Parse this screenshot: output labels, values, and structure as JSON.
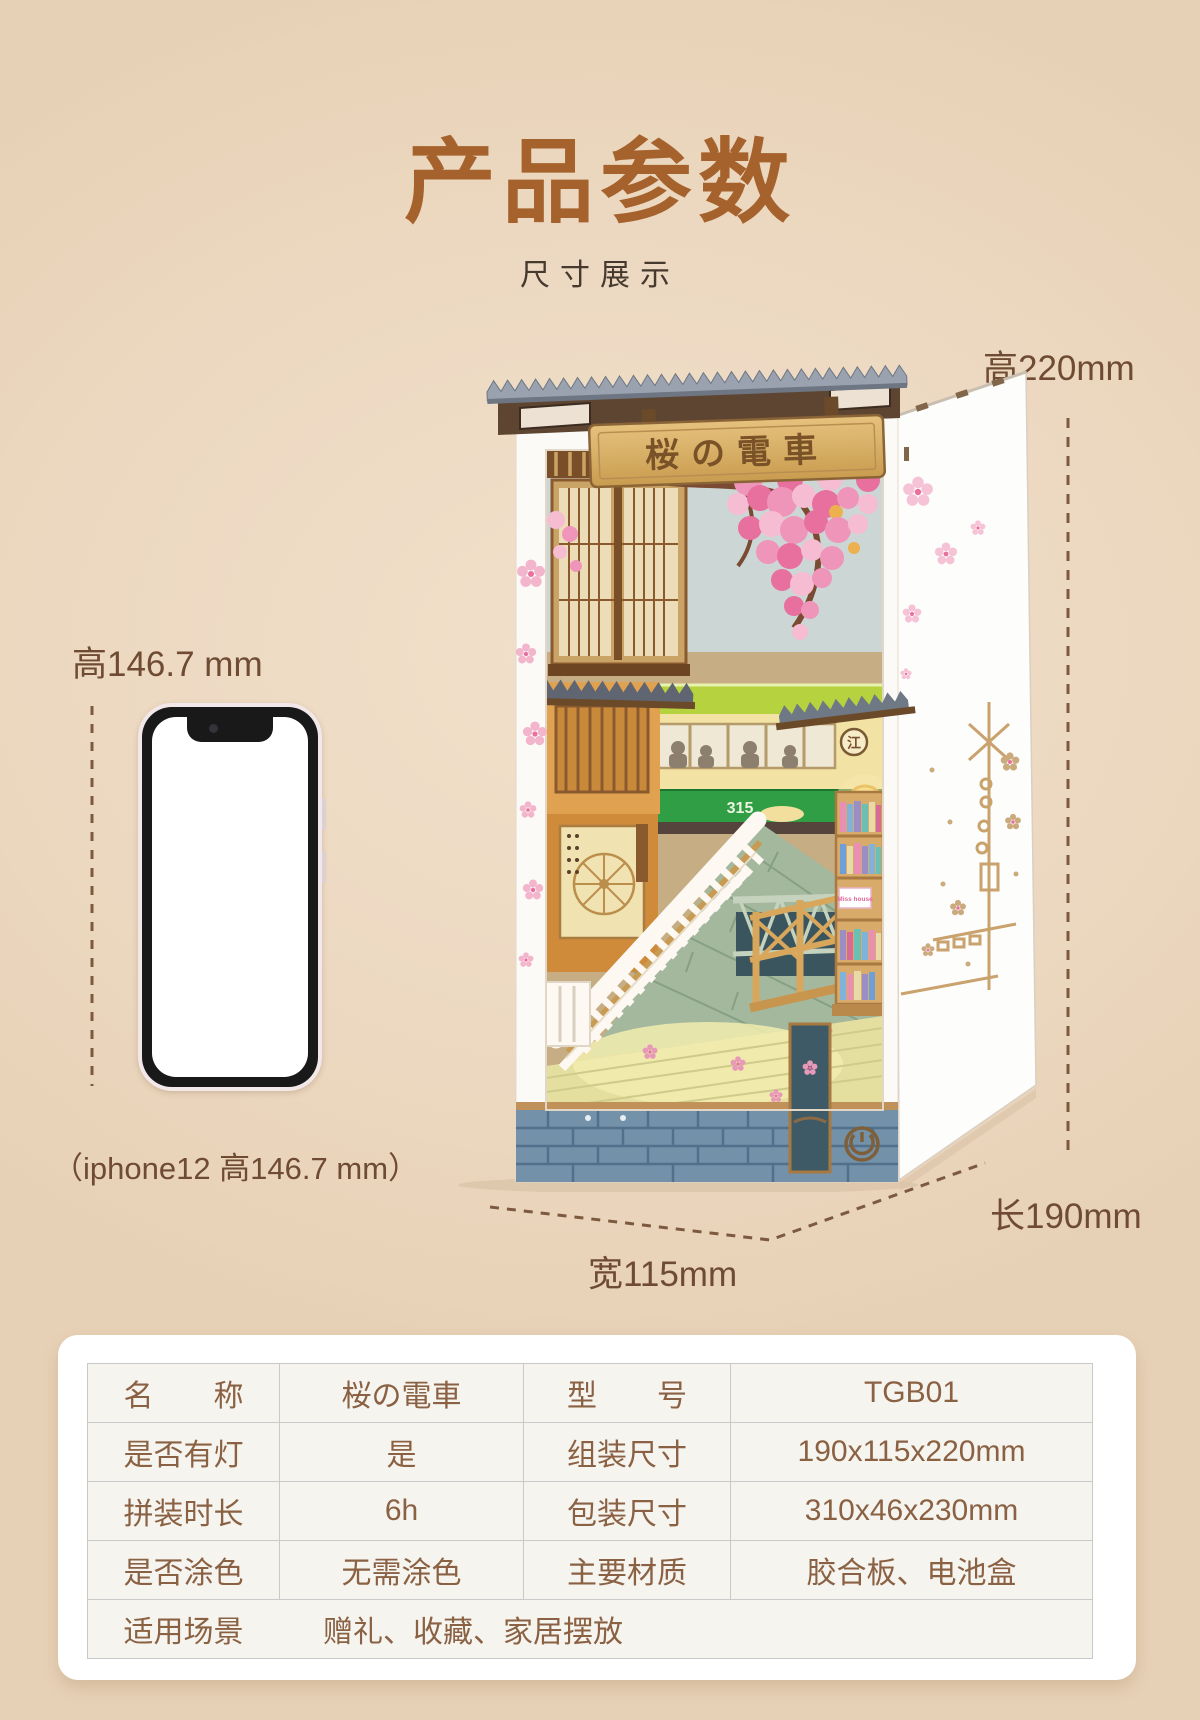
{
  "header": {
    "title": "产品参数",
    "subtitle": "尺寸展示"
  },
  "annotations": {
    "height_label": "高220mm",
    "length_label": "长190mm",
    "width_label": "宽115mm",
    "phone_height_label": "高146.7 mm",
    "phone_caption": "（iphone12 高146.7 mm）"
  },
  "product": {
    "sign_text": "桜の電車",
    "tram_number": "315",
    "tram_badge": "江",
    "bookshelf_card": "Miss house"
  },
  "colors": {
    "accent_brown": "#a5622c",
    "label_brown": "#6e4b32",
    "dash_brown": "#7d5a3f",
    "table_text": "#8a6143"
  },
  "spec_table": {
    "rows": [
      {
        "c1": "名　　称",
        "c2": "桜の電車",
        "c3": "型　　号",
        "c4": "TGB01"
      },
      {
        "c1": "是否有灯",
        "c2": "是",
        "c3": "组装尺寸",
        "c4": "190x115x220mm"
      },
      {
        "c1": "拼装时长",
        "c2": "6h",
        "c3": "包装尺寸",
        "c4": "310x46x230mm"
      },
      {
        "c1": "是否涂色",
        "c2": "无需涂色",
        "c3": "主要材质",
        "c4": "胶合板、电池盒"
      },
      {
        "c1": "适用场景",
        "c2": "赠礼、收藏、家居摆放"
      }
    ]
  }
}
